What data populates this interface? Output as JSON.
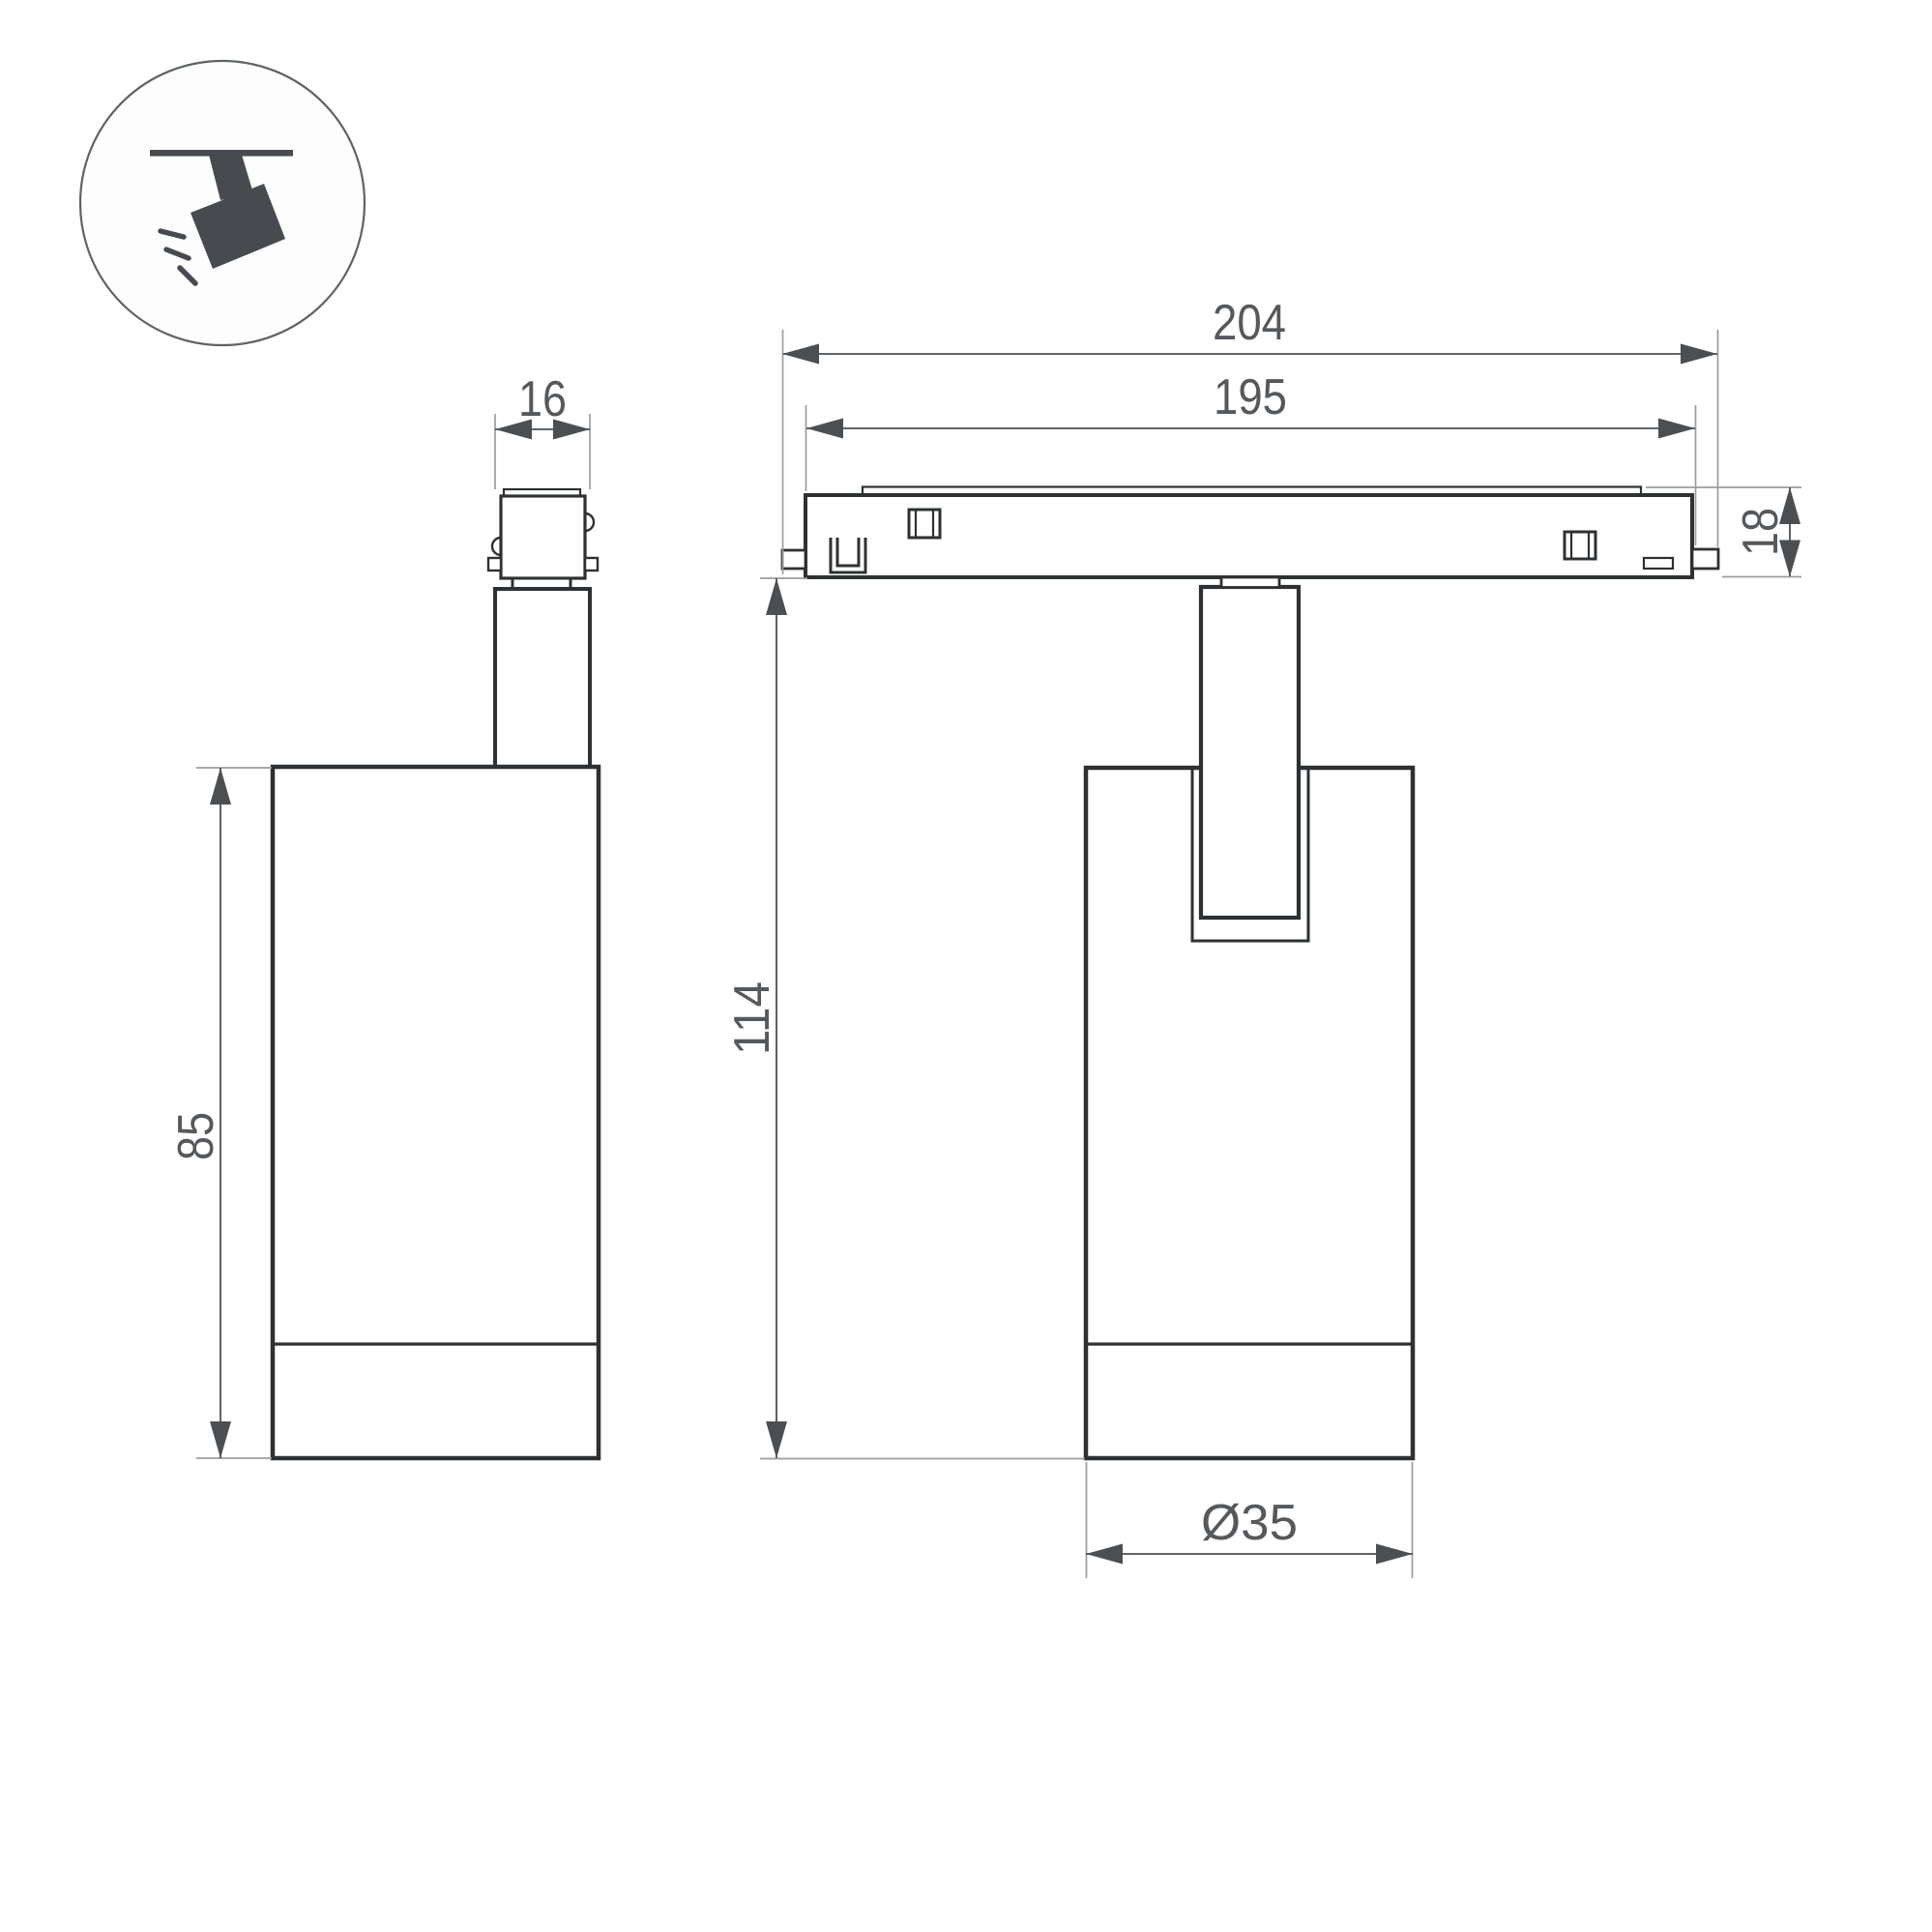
{
  "title": "track-spotlight-dimension-drawing",
  "icon": {
    "name": "ceiling-track-spotlight-icon"
  },
  "dimensions": {
    "track_outer_length": "204",
    "track_inner_length": "195",
    "adapter_width": "16",
    "track_height": "18",
    "body_height": "85",
    "overall_height": "114",
    "body_diameter": "Ø35"
  },
  "colors": {
    "line": "#2e3133",
    "dimension": "#4c4f52",
    "extension": "#9a9d9f",
    "label": "#56595c",
    "icon_fill": "#474b4f",
    "icon_stroke": "#5e6367",
    "background": "#ffffff"
  }
}
